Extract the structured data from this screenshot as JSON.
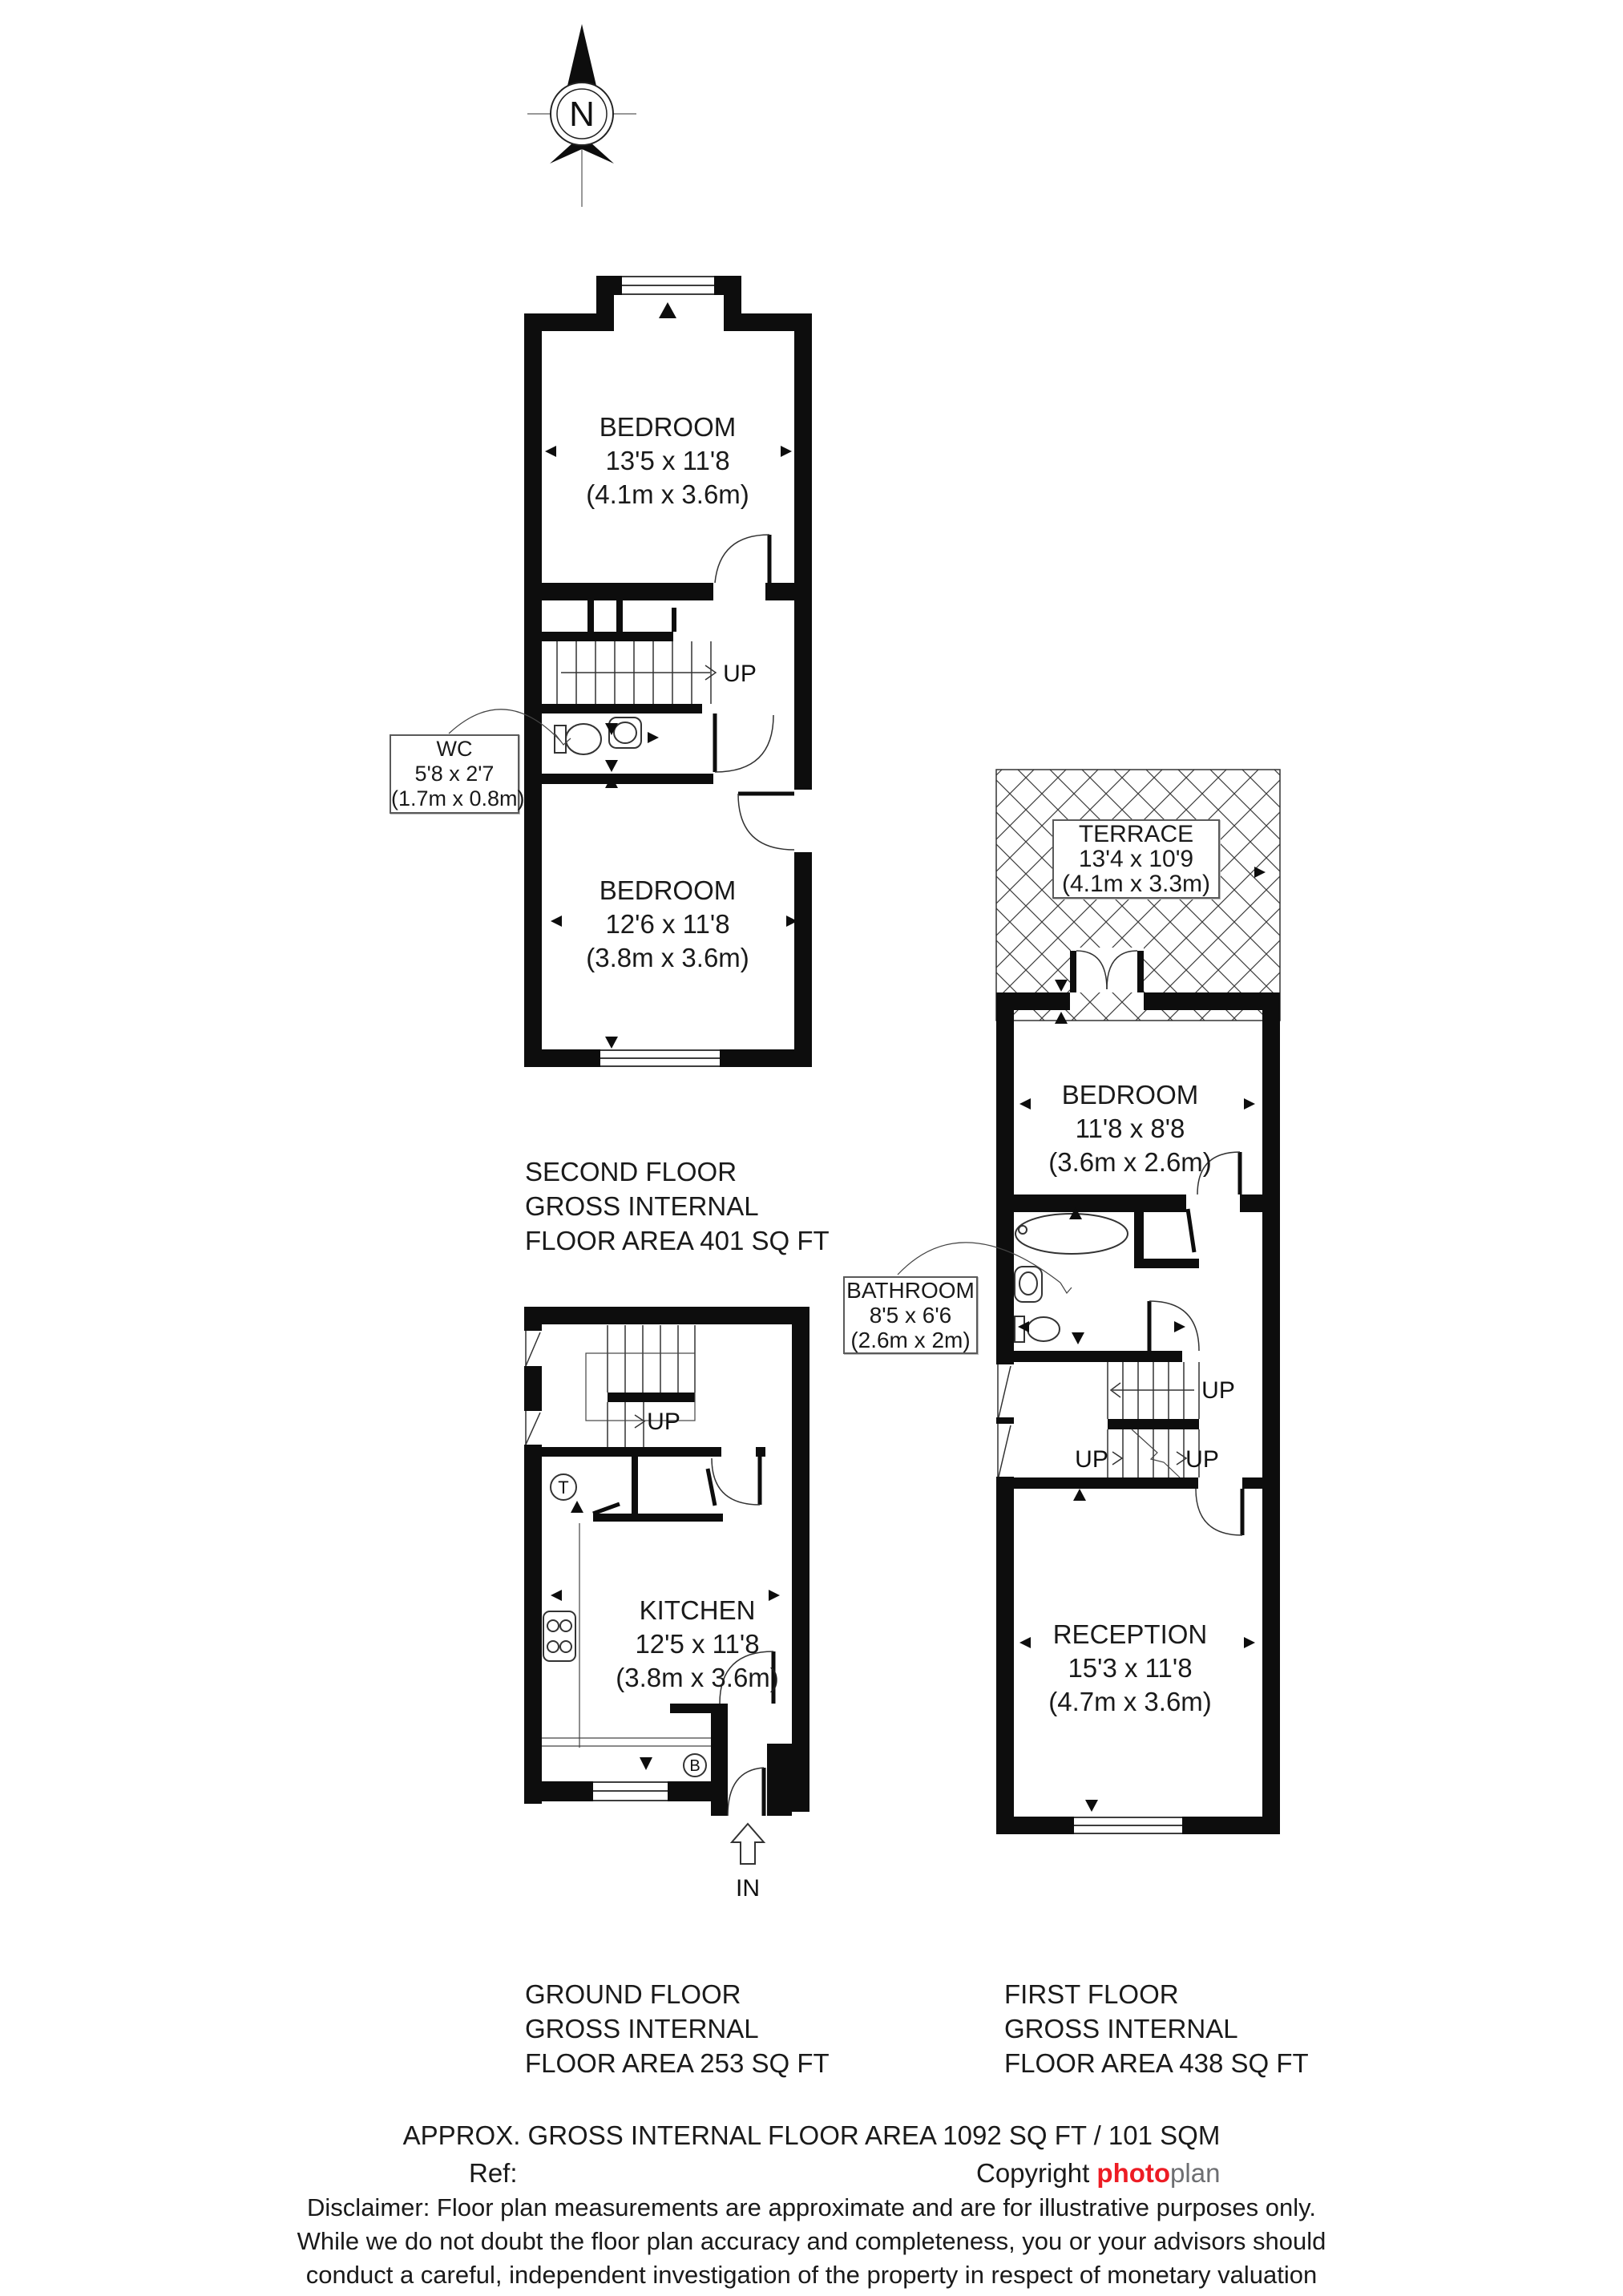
{
  "colors": {
    "ink": "#1a1a1a",
    "wall": "#0d0d0d",
    "brand_red": "#ed1c24",
    "brand_grey": "#6d6e71"
  },
  "compass": {
    "letter": "N"
  },
  "second_floor": {
    "bedroom_front": {
      "name": "BEDROOM",
      "imperial": "13'5 x 11'8",
      "metric": "(4.1m x 3.6m)"
    },
    "bedroom_back": {
      "name": "BEDROOM",
      "imperial": "12'6 x 11'8",
      "metric": "(3.8m x 3.6m)"
    },
    "wc": {
      "name": "WC",
      "imperial": "5'8 x 2'7",
      "metric": "(1.7m x 0.8m)"
    },
    "up_label": "UP",
    "title_line1": "SECOND FLOOR",
    "title_line2": "GROSS INTERNAL",
    "title_line3": "FLOOR AREA 401 SQ FT"
  },
  "ground_floor": {
    "kitchen": {
      "name": "KITCHEN",
      "imperial": "12'5 x 11'8",
      "metric": "(3.8m x 3.6m)"
    },
    "up_label": "UP",
    "tank_symbol": "T",
    "boiler_symbol": "B",
    "entrance_label": "IN",
    "title_line1": "GROUND FLOOR",
    "title_line2": "GROSS INTERNAL",
    "title_line3": "FLOOR AREA 253 SQ FT"
  },
  "first_floor": {
    "terrace": {
      "name": "TERRACE",
      "imperial": "13'4 x 10'9",
      "metric": "(4.1m x 3.3m)"
    },
    "bedroom": {
      "name": "BEDROOM",
      "imperial": "11'8 x 8'8",
      "metric": "(3.6m x 2.6m)"
    },
    "bathroom": {
      "name": "BATHROOM",
      "imperial": "8'5 x 6'6",
      "metric": "(2.6m x 2m)"
    },
    "up_label_top": "UP",
    "up_label_left": "UP",
    "up_label_right": "UP",
    "title_line1": "FIRST FLOOR",
    "title_line2": "GROSS INTERNAL",
    "title_line3": "FLOOR AREA 438 SQ FT"
  },
  "footer": {
    "total_area": "APPROX. GROSS INTERNAL FLOOR AREA 1092 SQ FT / 101 SQM",
    "ref_label": "Ref:",
    "copyright_label": "Copyright",
    "brand_photo": "photo",
    "brand_plan": "plan",
    "disclaimer_line1": "Disclaimer: Floor plan measurements are approximate and are for illustrative purposes only.",
    "disclaimer_line2": "While we do not doubt the floor plan accuracy and completeness, you or your advisors should",
    "disclaimer_line3": "conduct a careful, independent investigation of the property in respect of monetary valuation"
  }
}
